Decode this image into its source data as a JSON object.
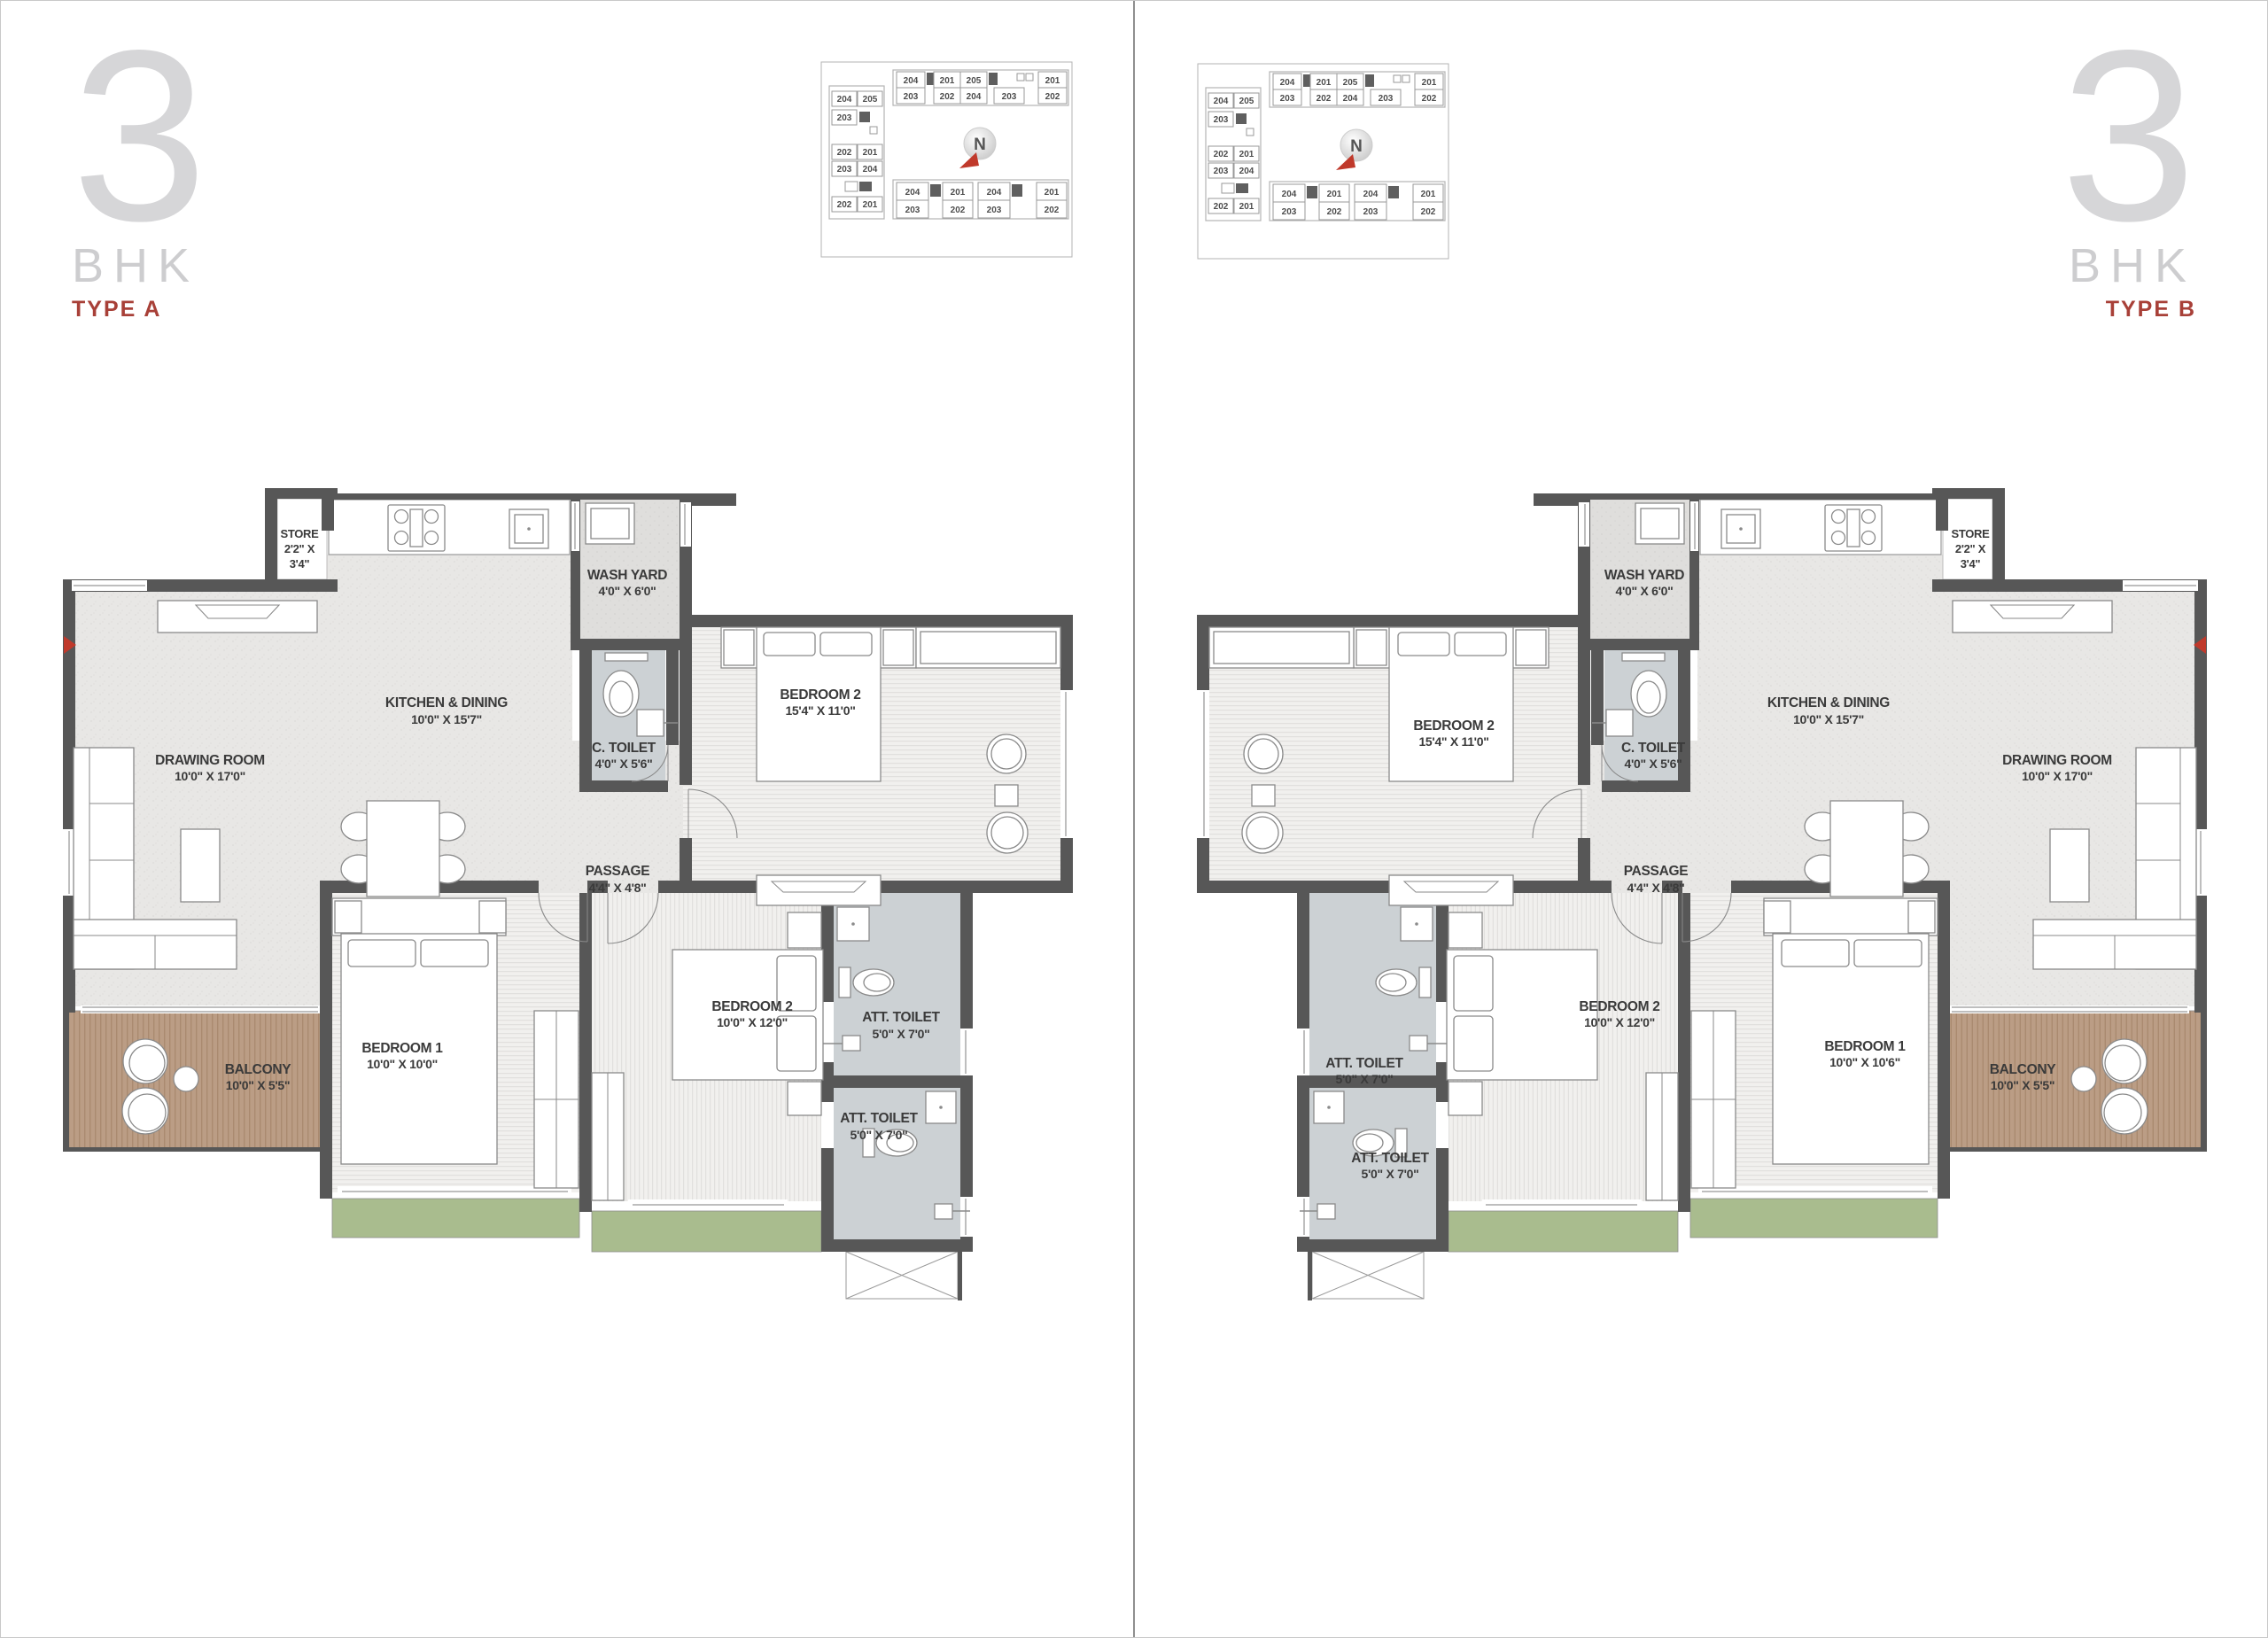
{
  "titles": {
    "left": {
      "number": "3",
      "sub": "BHK",
      "type": "TYPE A"
    },
    "right": {
      "number": "3",
      "sub": "BHK",
      "type": "TYPE B"
    }
  },
  "keyplan": {
    "compass": "N",
    "left_tower": {
      "r0": [
        "204",
        "205"
      ],
      "r1": [
        "203"
      ],
      "r2": [
        "202",
        "201"
      ],
      "r3": [
        "203",
        "204"
      ],
      "r4": [
        "202",
        "201"
      ]
    },
    "top_strip": {
      "r1": [
        "204",
        "201",
        "205",
        "201"
      ],
      "r2": [
        "203",
        "202",
        "204",
        "203",
        "202"
      ]
    },
    "bottom_strip": {
      "r1": [
        "204",
        "201",
        "204",
        "201"
      ],
      "r2": [
        "203",
        "202",
        "203",
        "202"
      ]
    }
  },
  "plan_a": {
    "drawing_room": {
      "name": "DRAWING ROOM",
      "dim": "10'0\" X 17'0\""
    },
    "kitchen": {
      "name": "KITCHEN & DINING",
      "dim": "10'0\" X 15'7\""
    },
    "store": {
      "name": "STORE",
      "dim1": "2'2\" X",
      "dim2": "3'4\""
    },
    "wash_yard": {
      "name": "WASH YARD",
      "dim": "4'0\" X 6'0\""
    },
    "c_toilet": {
      "name": "C. TOILET",
      "dim": "4'0\" X 5'6\""
    },
    "passage": {
      "name": "PASSAGE",
      "dim": "4'4\" X 4'8\""
    },
    "bedroom2_top": {
      "name": "BEDROOM 2",
      "dim": "15'4\" X 11'0\""
    },
    "bedroom1": {
      "name": "BEDROOM 1",
      "dim": "10'0\" X 10'0\""
    },
    "bedroom2_bottom": {
      "name": "BEDROOM 2",
      "dim": "10'0\" X 12'0\""
    },
    "att_toilet_upper": {
      "name": "ATT. TOILET",
      "dim": "5'0\" X 7'0\""
    },
    "att_toilet_lower": {
      "name": "ATT. TOILET",
      "dim": "5'0\" X 7'0\""
    },
    "balcony": {
      "name": "BALCONY",
      "dim": "10'0\" X 5'5\""
    }
  },
  "plan_b": {
    "drawing_room": {
      "name": "DRAWING ROOM",
      "dim": "10'0\" X 17'0\""
    },
    "kitchen": {
      "name": "KITCHEN & DINING",
      "dim": "10'0\" X 15'7\""
    },
    "store": {
      "name": "STORE",
      "dim1": "2'2\" X",
      "dim2": "3'4\""
    },
    "wash_yard": {
      "name": "WASH YARD",
      "dim": "4'0\" X 6'0\""
    },
    "c_toilet": {
      "name": "C. TOILET",
      "dim": "4'0\" X 5'6\""
    },
    "passage": {
      "name": "PASSAGE",
      "dim": "4'4\" X 4'8\""
    },
    "bedroom2_top": {
      "name": "BEDROOM 2",
      "dim": "15'4\" X 11'0\""
    },
    "bedroom1": {
      "name": "BEDROOM 1",
      "dim": "10'0\" X 10'6\""
    },
    "bedroom2_bottom": {
      "name": "BEDROOM 2",
      "dim": "10'0\" X 12'0\""
    },
    "att_toilet_upper": {
      "name": "ATT. TOILET",
      "dim": "5'0\" X 7'0\""
    },
    "att_toilet_lower": {
      "name": "ATT. TOILET",
      "dim": "5'0\" X 7'0\""
    },
    "balcony": {
      "name": "BALCONY",
      "dim": "10'0\" X 5'5\""
    }
  },
  "colors": {
    "accent_red": "#a84038",
    "wall": "#575757",
    "highlight_unit": "#a58d79",
    "adjacent_unit": "#dcd4c9",
    "balcony": "#bb9d85",
    "garden_green": "#a9bc8e",
    "toilet_floor": "#ccd1d4"
  }
}
